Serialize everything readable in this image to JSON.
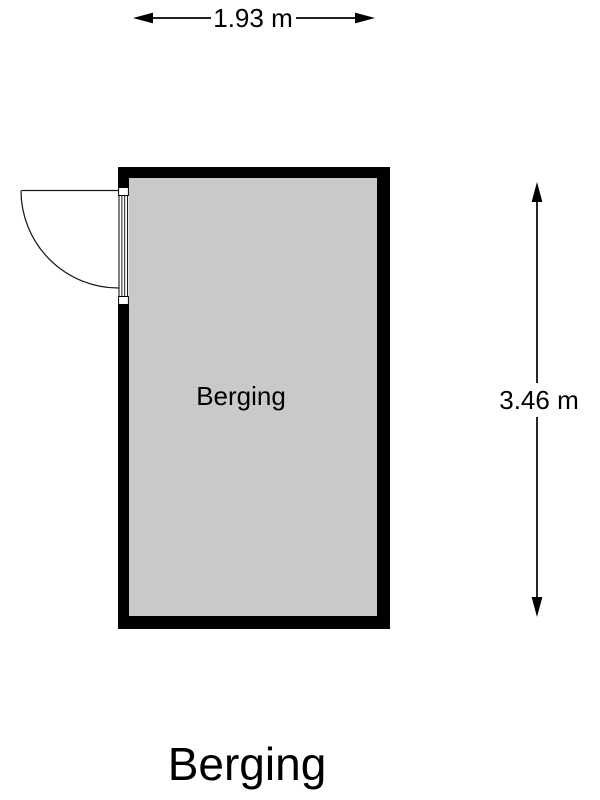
{
  "floorplan": {
    "title": "Berging",
    "room": {
      "label": "Berging",
      "wall_color": "#000000",
      "floor_color": "#c9c9c9"
    },
    "dimensions": {
      "width": {
        "label": "1.93 m"
      },
      "height": {
        "label": "3.46 m"
      }
    },
    "door": {
      "wall": "left",
      "swing": "outward"
    }
  }
}
